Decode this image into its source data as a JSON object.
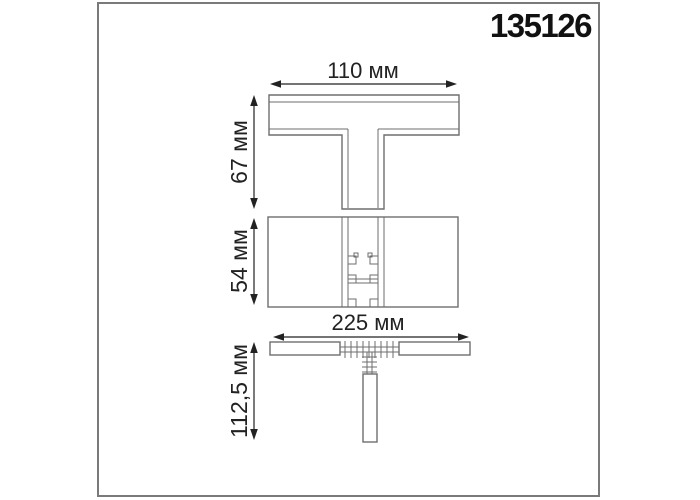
{
  "title": {
    "part_number": "135126"
  },
  "drawing": {
    "type": "technical-dimension-drawing",
    "dimensions": {
      "top_width": "110 мм",
      "top_height": "67 мм",
      "middle_height": "54 мм",
      "bottom_width": "225 мм",
      "bottom_height": "112,5 мм"
    }
  },
  "colors": {
    "background": "#ffffff",
    "frame": "#7a7a7a",
    "outline": "#6e6e6e",
    "inner_line": "#6e6e6e",
    "dimension": "#222222",
    "text": "#111111"
  }
}
